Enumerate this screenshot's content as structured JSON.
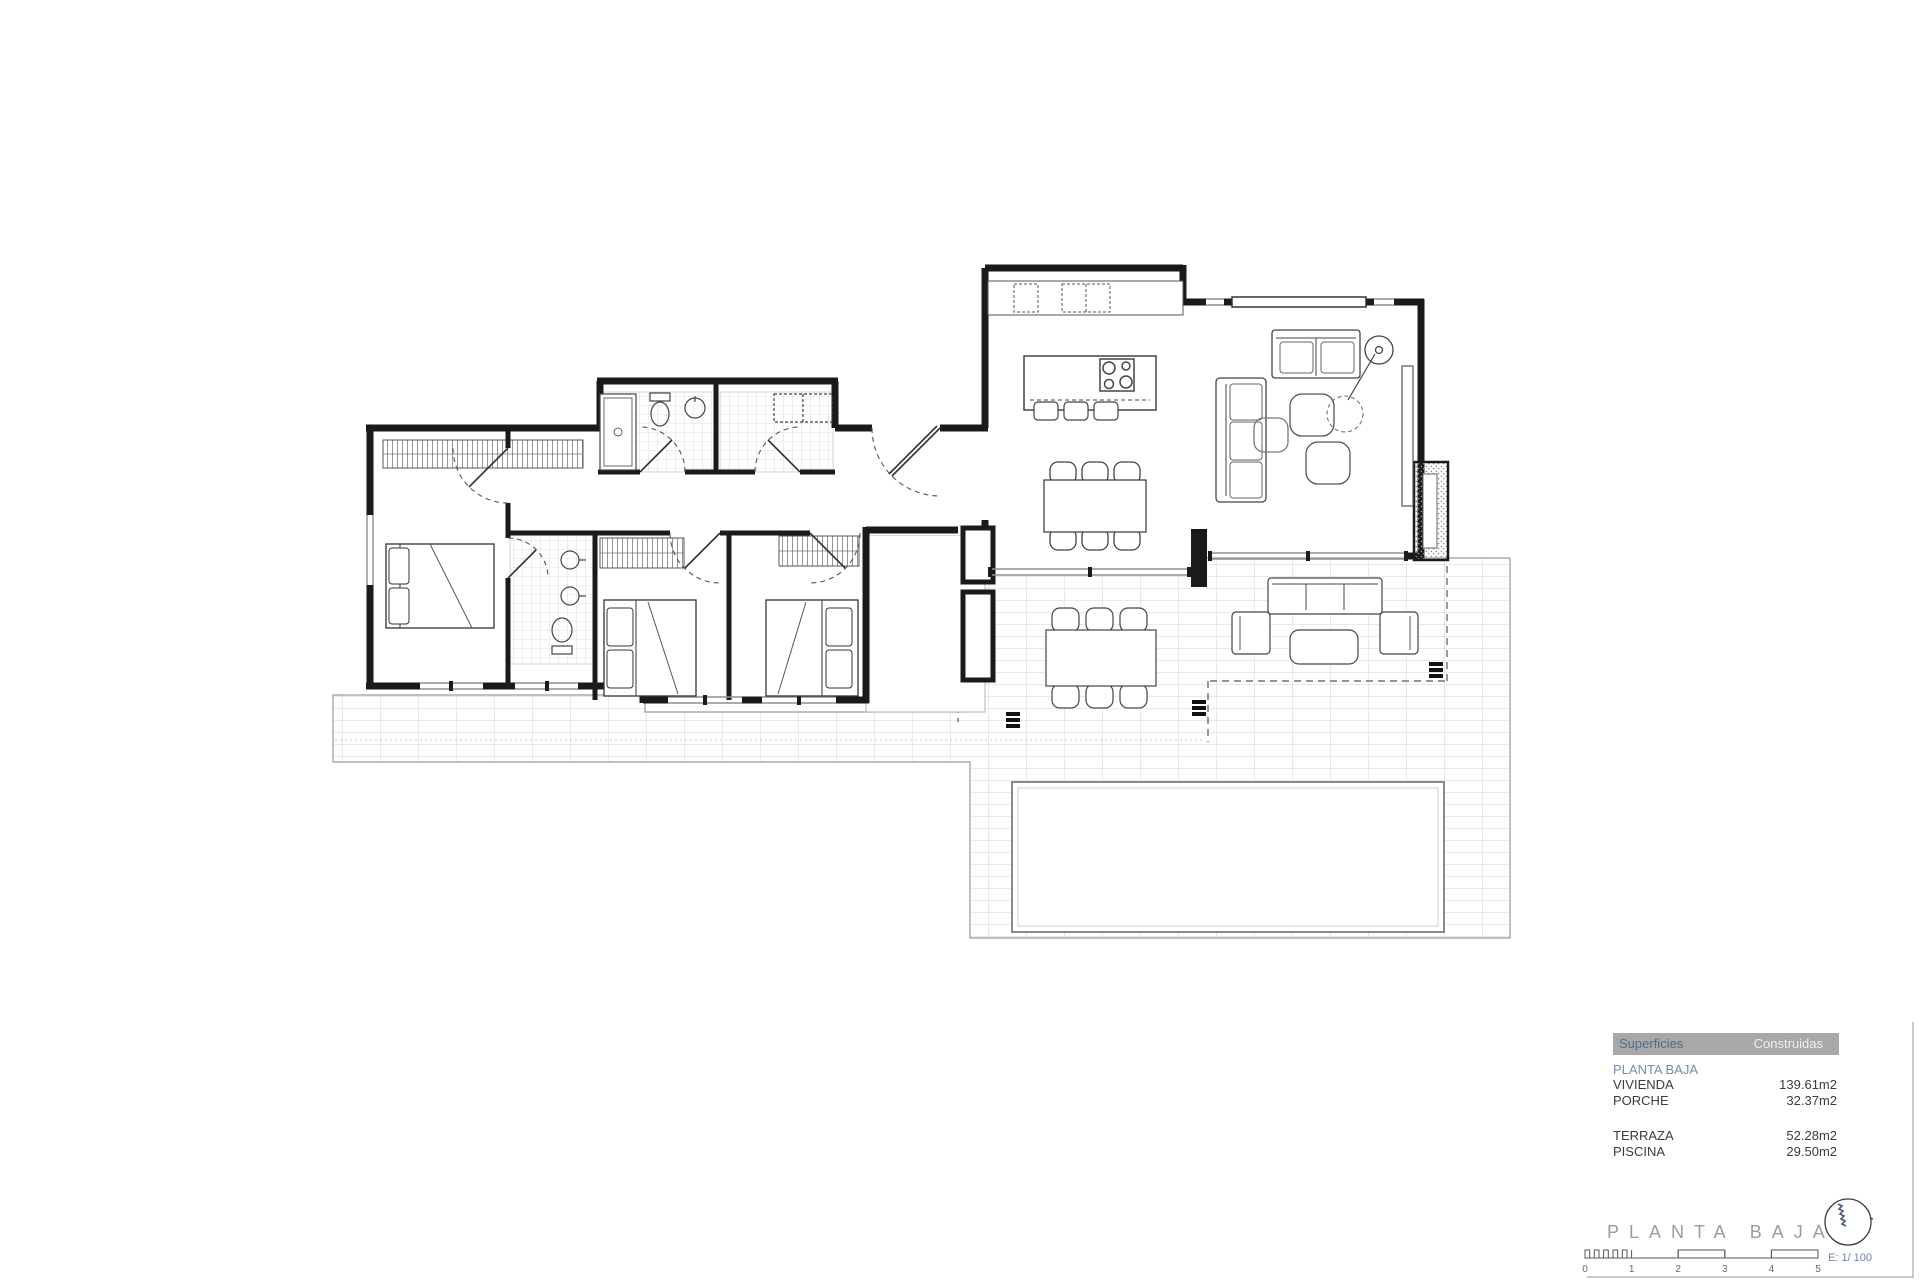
{
  "legend": {
    "header": {
      "col1": "Superficies",
      "col2": "Construidas"
    },
    "section": "PLANTA BAJA",
    "rows": [
      {
        "label": "VIVIENDA",
        "value": "139.61m2"
      },
      {
        "label": "PORCHE",
        "value": "32.37m2"
      },
      {
        "label": "TERRAZA",
        "value": "52.28m2"
      },
      {
        "label": "PISCINA",
        "value": "29.50m2"
      }
    ]
  },
  "title_block": {
    "title": "PLANTA BAJA",
    "scale_label": "E: 1/ 100",
    "scale_ticks": [
      "0",
      "1",
      "2",
      "3",
      "4",
      "5"
    ]
  },
  "icons": {
    "north_indicator": "compass-circle-with-scribble"
  },
  "colors": {
    "wall": "#1a1a1a",
    "accent_blue": "#4a6e96",
    "legend_header_gray": "#a8a8a8",
    "section_blue": "#6f8fae",
    "title_gray": "#9c9c9c",
    "scale_text_blue": "#6e7f9c",
    "tile_line_gray": "#d3d3d3"
  }
}
